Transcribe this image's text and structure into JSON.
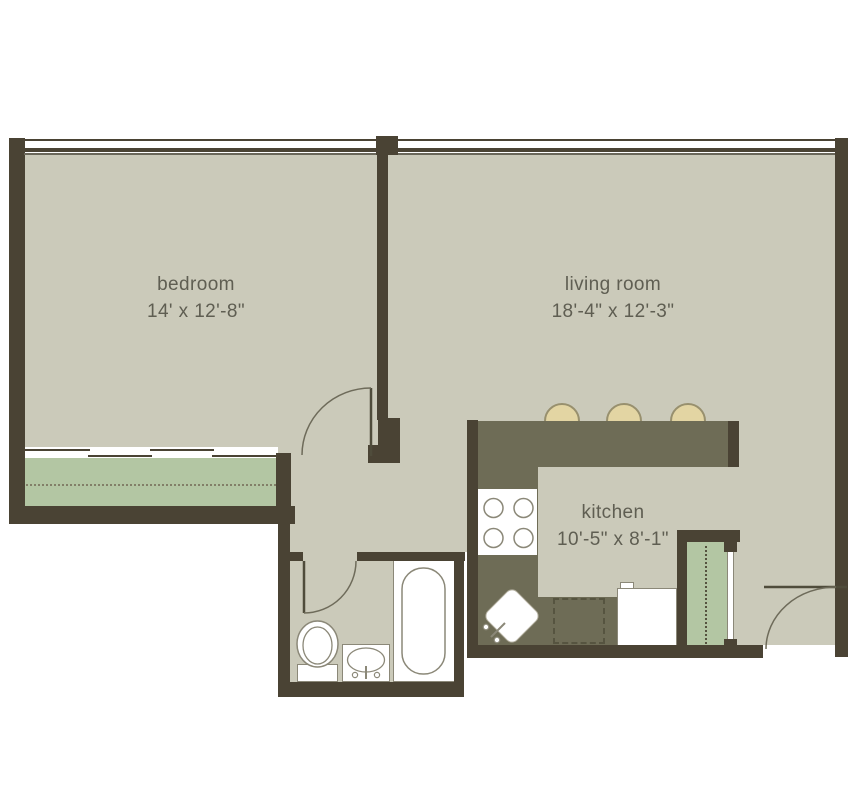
{
  "floorplan": {
    "rooms": [
      {
        "name": "bedroom",
        "dimensions": "14' x 12'-8\""
      },
      {
        "name": "living room",
        "dimensions": "18'-4\" x 12'-3\""
      },
      {
        "name": "kitchen",
        "dimensions": "10'-5\" x 8'-1\""
      }
    ],
    "fixtures": [
      "window-wall",
      "sliding-closet-doors",
      "closet-rod",
      "breakfast-bar",
      "bar-stools",
      "cooktop",
      "kitchen-sink",
      "dishwasher",
      "refrigerator",
      "pantry-closet",
      "bathtub",
      "toilet",
      "vanity-sink",
      "bedroom-door",
      "bathroom-door",
      "entry-door"
    ],
    "colors": {
      "wall": "#4a4334",
      "floor": "#cbcaba",
      "counter": "#6e6c56",
      "closet_green": "#b3c6a3",
      "stool": "#e3d5a3",
      "fixture_outline": "#8b8878",
      "text": "#5f5e52",
      "background": "#ffffff"
    }
  }
}
